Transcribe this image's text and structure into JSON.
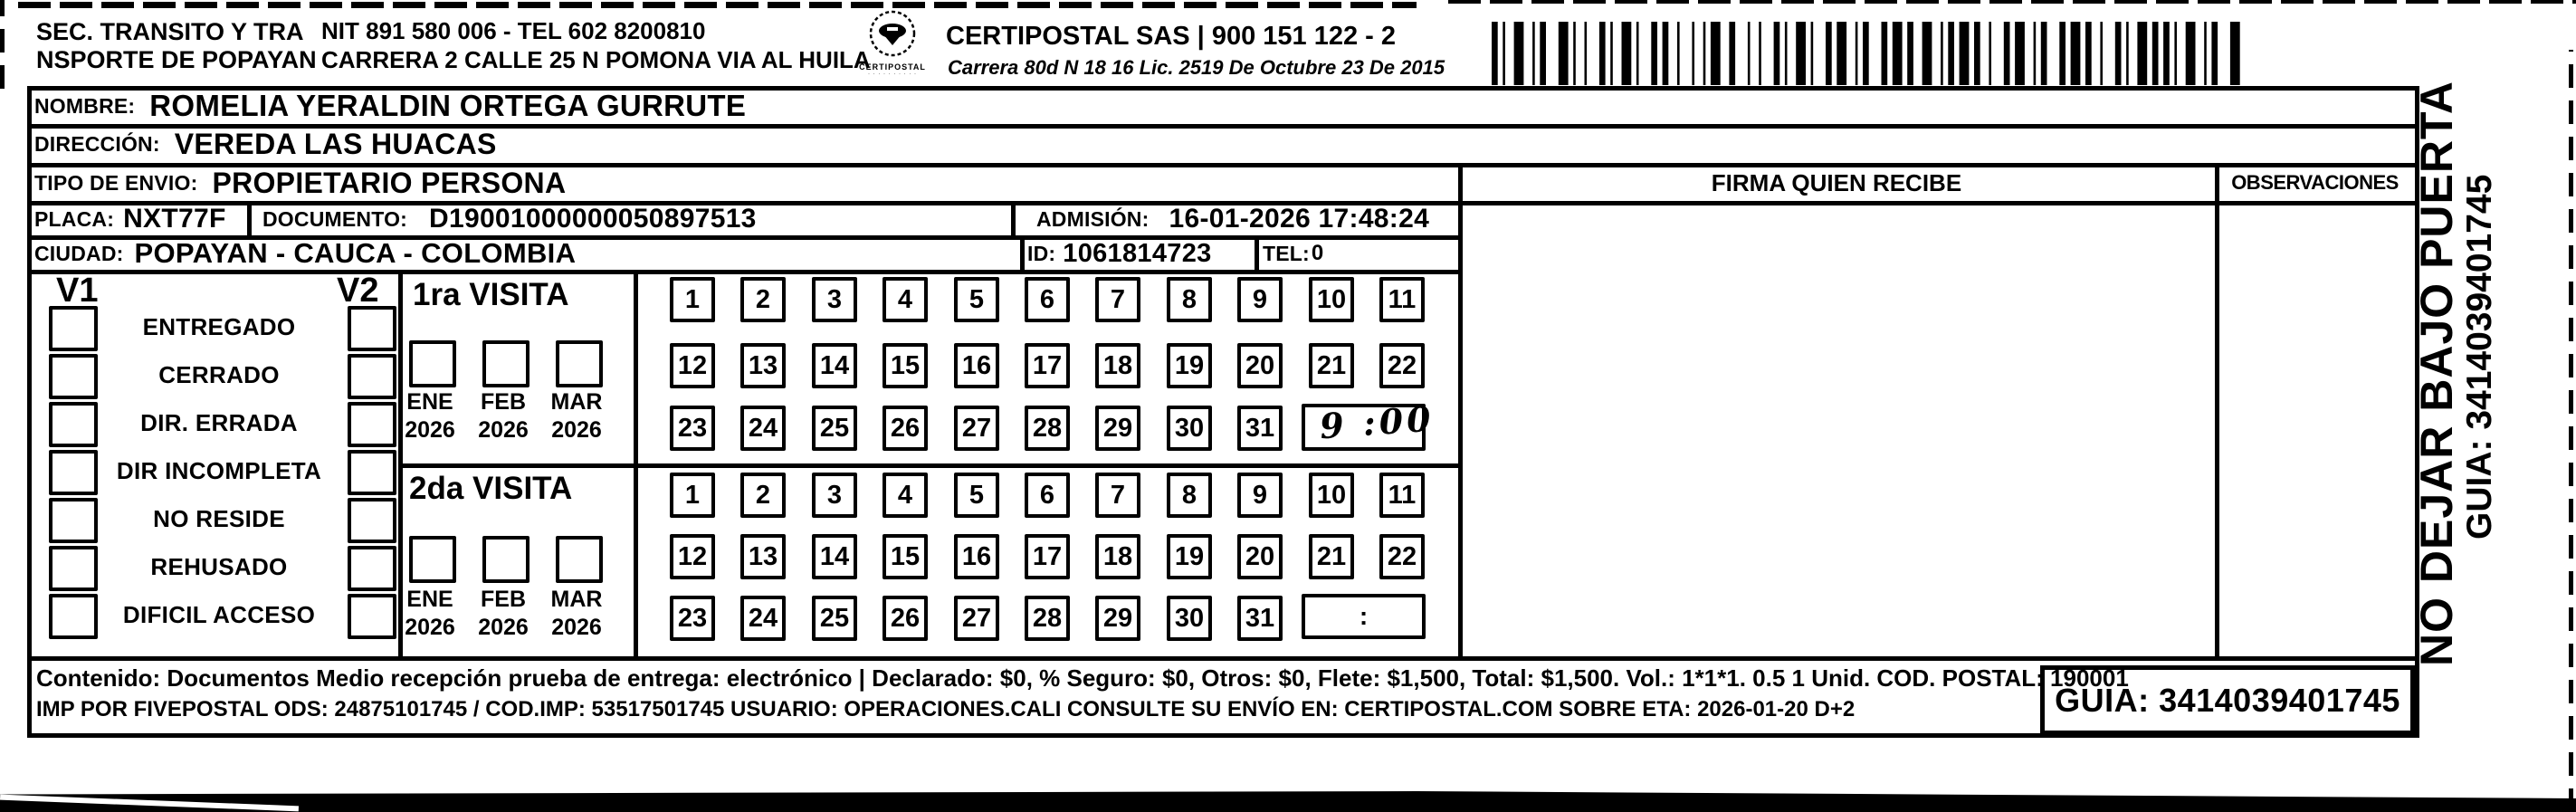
{
  "header": {
    "org_line1": "SEC. TRANSITO Y TRA",
    "org_line2": "NSPORTE DE POPAYAN",
    "nit_tel": "NIT 891 580 006 - TEL 602 8200810",
    "address": "CARRERA 2 CALLE 25 N POMONA VIA AL HUILA",
    "logo_caption": "CERTIPOSTAL",
    "company_line": "CERTIPOSTAL SAS | 900 151 122 - 2",
    "company_sub": "Carrera 80d N 18 16  Lic. 2519 De Octubre 23 De 2015"
  },
  "recipient": {
    "nombre_label": "NOMBRE:",
    "nombre": "ROMELIA YERALDIN ORTEGA GURRUTE",
    "direccion_label": "DIRECCIÓN:",
    "direccion": "VEREDA LAS HUACAS",
    "tipo_label": "TIPO DE ENVIO:",
    "tipo": "PROPIETARIO PERSONA"
  },
  "shipment": {
    "placa_label": "PLACA:",
    "placa": "NXT77F",
    "documento_label": "DOCUMENTO:",
    "documento": "D19001000000050897513",
    "admision_label": "ADMISIÓN:",
    "admision": "16-01-2026 17:48:24",
    "ciudad_label": "CIUDAD:",
    "ciudad": "POPAYAN - CAUCA - COLOMBIA",
    "id_label": "ID:",
    "id": "1061814723",
    "tel_label": "TEL:",
    "tel": "0"
  },
  "delivery_status": {
    "v1_label": "V1",
    "v2_label": "V2",
    "options": [
      "ENTREGADO",
      "CERRADO",
      "DIR. ERRADA",
      "DIR INCOMPLETA",
      "NO RESIDE",
      "REHUSADO",
      "DIFICIL ACCESO"
    ],
    "v1_checked_option": "DIR INCOMPLETA",
    "v1_check_mark": "α"
  },
  "visit1": {
    "title": "1ra VISITA",
    "months": [
      "ENE",
      "FEB",
      "MAR"
    ],
    "years": [
      "2026",
      "2026",
      "2026"
    ],
    "checked_month": "ENE",
    "month_mark": "α",
    "day_rows": [
      [
        "1",
        "2",
        "3",
        "4",
        "5",
        "6",
        "7",
        "8",
        "9",
        "10",
        "11"
      ],
      [
        "12",
        "13",
        "14",
        "15",
        "16",
        "17",
        "18",
        "19",
        "20",
        "21",
        "22"
      ],
      [
        "23",
        "24",
        "25",
        "26",
        "27",
        "28",
        "29",
        "30",
        "31"
      ]
    ],
    "marked_day": "20",
    "day_mark": "X",
    "time_value": "9 :00"
  },
  "visit2": {
    "title": "2da VISITA",
    "months": [
      "ENE",
      "FEB",
      "MAR"
    ],
    "years": [
      "2026",
      "2026",
      "2026"
    ],
    "day_rows": [
      [
        "1",
        "2",
        "3",
        "4",
        "5",
        "6",
        "7",
        "8",
        "9",
        "10",
        "11"
      ],
      [
        "12",
        "13",
        "14",
        "15",
        "16",
        "17",
        "18",
        "19",
        "20",
        "21",
        "22"
      ],
      [
        "23",
        "24",
        "25",
        "26",
        "27",
        "28",
        "29",
        "30",
        "31"
      ]
    ],
    "time_value": ":"
  },
  "right_panel": {
    "firma_header": "FIRMA QUIEN RECIBE",
    "observaciones_header": "OBSERVACIONES"
  },
  "side_note": {
    "line1": "NO DEJAR BAJO PUERTA",
    "line2": "GUIA: 3414039401745"
  },
  "footer": {
    "line1": "Contenido: Documentos Medio recepción prueba de entrega: electrónico | Declarado: $0, % Seguro: $0, Otros: $0, Flete: $1,500, Total: $1,500. Vol.: 1*1*1. 0.5  1 Unid. COD. POSTAL: 190001",
    "line2": "IMP POR FIVEPOSTAL ODS: 24875101745 / COD.IMP: 53517501745 USUARIO: OPERACIONES.CALI CONSULTE SU ENVÍO EN: CERTIPOSTAL.COM SOBRE ETA: 2026-01-20 D+2",
    "guia_label": "GUIA: 3414039401745"
  },
  "colors": {
    "ink": "#000000",
    "paper": "#ffffff"
  }
}
